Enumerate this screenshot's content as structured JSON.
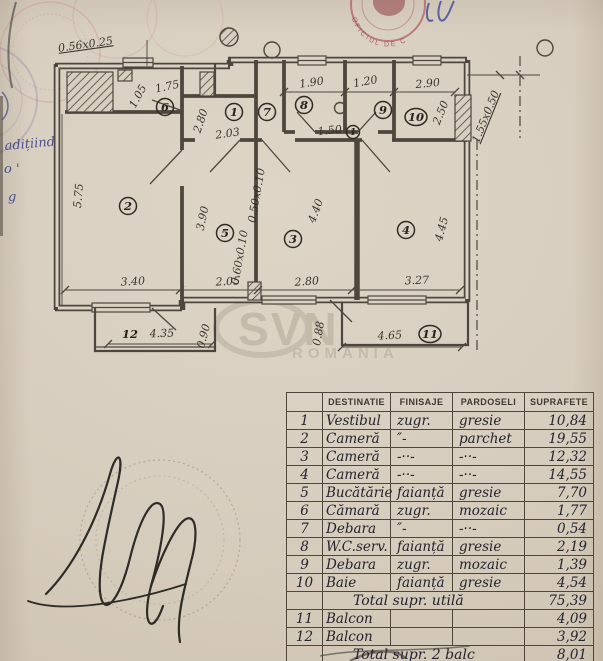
{
  "margin_notes": {
    "line1": "adițiind",
    "line2": "o  '",
    "line3": "g"
  },
  "stamp": {
    "arc_text": "OFICIUL DE C"
  },
  "watermark": {
    "line1": "SVN",
    "line2": "ROMANIA"
  },
  "plan": {
    "dimensions": [
      {
        "text": "0.56x0.25",
        "x": 86,
        "y": 48,
        "rot": -8,
        "u": 1
      },
      {
        "text": "1.05",
        "x": 141,
        "y": 98,
        "rot": -62
      },
      {
        "text": "1.75",
        "x": 168,
        "y": 90,
        "rot": -12
      },
      {
        "text": "2.80",
        "x": 204,
        "y": 122,
        "rot": -72
      },
      {
        "text": "2.03",
        "x": 228,
        "y": 137,
        "rot": -8
      },
      {
        "text": "1.90",
        "x": 312,
        "y": 86,
        "rot": -8
      },
      {
        "text": "1.20",
        "x": 366,
        "y": 85,
        "rot": -10
      },
      {
        "text": "2.90",
        "x": 428,
        "y": 87,
        "rot": -5
      },
      {
        "text": "2.50",
        "x": 444,
        "y": 114,
        "rot": -68
      },
      {
        "text": "1.55x0.50",
        "x": 489,
        "y": 118,
        "rot": -68,
        "u": 1
      },
      {
        "text": "5.75",
        "x": 82,
        "y": 196,
        "rot": -85
      },
      {
        "text": "3.90",
        "x": 206,
        "y": 219,
        "rot": -78
      },
      {
        "text": "0.60x0.10",
        "x": 243,
        "y": 258,
        "rot": -80
      },
      {
        "text": "0.50x0.10",
        "x": 260,
        "y": 196,
        "rot": -80
      },
      {
        "text": "4.40",
        "x": 319,
        "y": 212,
        "rot": -70
      },
      {
        "text": "4.45",
        "x": 445,
        "y": 230,
        "rot": -75
      },
      {
        "text": "3.40",
        "x": 133,
        "y": 285,
        "rot": -3
      },
      {
        "text": "2.05",
        "x": 228,
        "y": 285,
        "rot": -3
      },
      {
        "text": "2.80",
        "x": 307,
        "y": 285,
        "rot": -4
      },
      {
        "text": "3.27",
        "x": 417,
        "y": 284,
        "rot": -2
      },
      {
        "text": "4.35",
        "x": 162,
        "y": 337,
        "rot": -2
      },
      {
        "text": "0.90",
        "x": 207,
        "y": 337,
        "rot": -75
      },
      {
        "text": "0.88",
        "x": 322,
        "y": 334,
        "rot": -80
      },
      {
        "text": "4.65",
        "x": 390,
        "y": 339,
        "rot": -3
      },
      {
        "text": "1.50",
        "x": 330,
        "y": 134,
        "rot": -6
      }
    ],
    "rooms": [
      {
        "num": "1",
        "x": 234,
        "y": 112
      },
      {
        "num": "2",
        "x": 128,
        "y": 206
      },
      {
        "num": "3",
        "x": 293,
        "y": 239
      },
      {
        "num": "4",
        "x": 406,
        "y": 230
      },
      {
        "num": "5",
        "x": 225,
        "y": 233
      },
      {
        "num": "6",
        "x": 165,
        "y": 107
      },
      {
        "num": "7",
        "x": 267,
        "y": 112
      },
      {
        "num": "8",
        "x": 304,
        "y": 105
      },
      {
        "num": "9",
        "x": 383,
        "y": 110
      },
      {
        "num": "10",
        "x": 416,
        "y": 117
      },
      {
        "num": "11",
        "x": 430,
        "y": 334
      },
      {
        "num": "12",
        "x": 130,
        "y": 334,
        "plain": true
      },
      {
        "num": "1",
        "x": 353,
        "y": 132,
        "small": true
      }
    ]
  },
  "table": {
    "headers": [
      "DESTINATIE",
      "FINISAJE",
      "PARDOSELI",
      "SUPRAFETE"
    ],
    "rows": [
      {
        "no": "1",
        "dest": "Vestibul",
        "fin": "zugr.",
        "par": "gresie",
        "sup": "10,84"
      },
      {
        "no": "2",
        "dest": "Cameră",
        "fin": "″-",
        "par": "parchet",
        "sup": "19,55"
      },
      {
        "no": "3",
        "dest": "Cameră",
        "fin": "-··-",
        "par": "-··-",
        "sup": "12,32"
      },
      {
        "no": "4",
        "dest": "Cameră",
        "fin": "-··-",
        "par": "-··-",
        "sup": "14,55"
      },
      {
        "no": "5",
        "dest": "Bucătărie",
        "fin": "faianță",
        "par": "gresie",
        "sup": "7,70"
      },
      {
        "no": "6",
        "dest": "Cămară",
        "fin": "zugr.",
        "par": "mozaic",
        "sup": "1,77"
      },
      {
        "no": "7",
        "dest": "Debara",
        "fin": "″-",
        "par": "-··-",
        "sup": "0,54"
      },
      {
        "no": "8",
        "dest": "W.C.serv.",
        "fin": "faianță",
        "par": "gresie",
        "sup": "2,19"
      },
      {
        "no": "9",
        "dest": "Debara",
        "fin": "zugr.",
        "par": "mozaic",
        "sup": "1,39"
      },
      {
        "no": "10",
        "dest": "Baie",
        "fin": "faianță",
        "par": "gresie",
        "sup": "4,54"
      },
      {
        "no": "",
        "dest": "Total supr. utilă",
        "sup": "75,39",
        "total": true
      },
      {
        "no": "11",
        "dest": "Balcon",
        "fin": "",
        "par": "",
        "sup": "4,09"
      },
      {
        "no": "12",
        "dest": "Balcon",
        "fin": "",
        "par": "",
        "sup": "3,92"
      },
      {
        "no": "",
        "dest": "Total supr. 2 balc",
        "sup": "8,01",
        "total": true
      }
    ]
  }
}
